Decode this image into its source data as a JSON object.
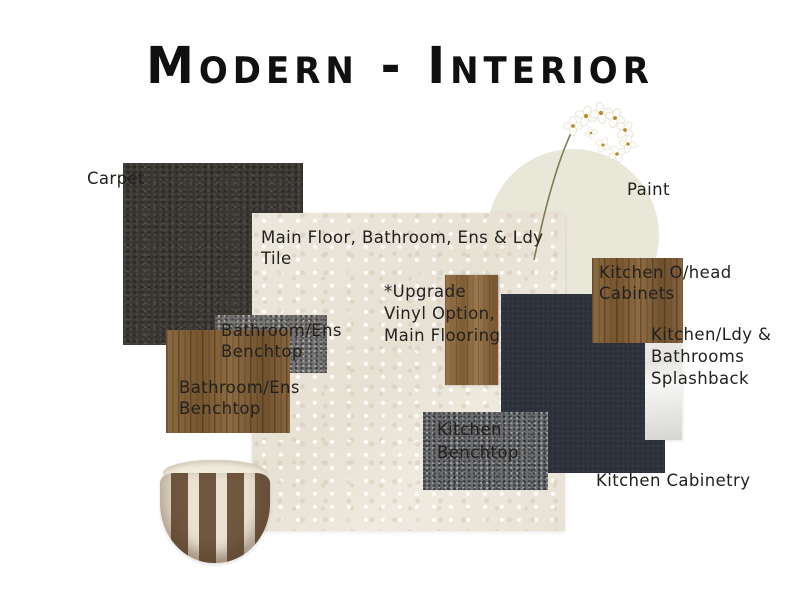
{
  "title": "Modern - Interior",
  "swatches": {
    "carpet": {
      "label": "Carpet",
      "color": "#3a3733"
    },
    "paint": {
      "label": "Paint",
      "color": "#e9e7d8"
    },
    "tile": {
      "label_lines": [
        "Main Floor, Bathroom, Ens & Ldy",
        "Tile"
      ],
      "color": "#ebe6db"
    },
    "ohead_cabinets": {
      "label_lines": [
        "Kitchen O/head",
        "Cabinets"
      ],
      "color": "#86653c"
    },
    "splashback": {
      "label_lines": [
        "Kitchen/Ldy &",
        "Bathrooms",
        "Splashback"
      ],
      "color": "#e8e7e4"
    },
    "kitchen_cabinetry": {
      "label": "Kitchen Cabinetry",
      "color": "#2b303a"
    },
    "vinyl": {
      "label_lines": [
        "*Upgrade",
        "Vinyl Option,",
        "Main Flooring"
      ],
      "color": "#8a6a44"
    },
    "kitchen_benchtop": {
      "label_lines": [
        "Kitchen",
        "Benchtop"
      ],
      "color": "#6a6c6e"
    },
    "bath_benchtop_stone": {
      "label_lines": [
        "Bathroom/Ens",
        "Benchtop"
      ],
      "color": "#767472"
    },
    "bath_benchtop_wood": {
      "label_lines": [
        "Bathroom/Ens",
        "Benchtop"
      ],
      "color": "#8a6a44"
    }
  },
  "decor": {
    "pot": "brown-cream striped ceramic pot",
    "flower": "white orchid stem"
  }
}
